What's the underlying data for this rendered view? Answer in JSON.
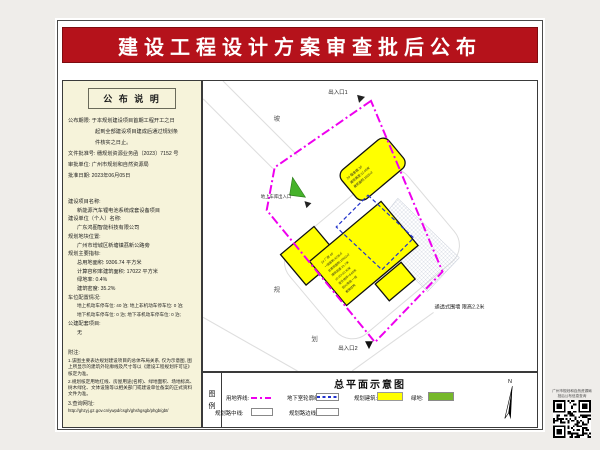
{
  "title": "建设工程设计方案审查批后公布",
  "left_panel": {
    "header": "公 布 说 明",
    "lines": [
      "公布期限: 于本规划建设项目首期工程开工之日",
      "起到全部建设项目建成后通过规划条",
      "件核实之日止。",
      "文件批准号: 穗规划资源业务函〔2023〕7152 号",
      "审批单位: 广州市规划和自然资源局",
      "批准日期: 2023年06月05日",
      "建设项目名称:",
      "新能源汽车锂电池系统成套设备项目",
      "建设单位（个人）名称:",
      "广东鸿图智能科技有限公司",
      "规划地块位置:",
      "广州市增城区新塘镇荔新公路旁",
      "规划主要指标:",
      "总用地面积: 9306.74 平方米",
      "计算容积率建筑面积: 17022 平方米",
      "绿地率: 0.4%",
      "建筑密度: 35.2%",
      "车位配置情况:",
      "地上机动车停车位: 40 泊; 地上非机动车停车位: 0 泊;",
      "地下机动车停车位: 0 泊; 地下非机动车停车位: 0 泊;",
      "公建配套项目:",
      "无",
      "附注:",
      "1.该图主要表达规划建设项目的总体布局关系, 仅为示意图, 图上所显示的建筑外轮廓线及尺寸等以《建设工程规划许可证》核定为准。",
      "2.规划核定用地红线、房屋用途(名称)、绿地面积、场地标高、树木绿化、文体设施等以相关部门或建设单位备案的正式资料文件为准。",
      "3.查询网址:",
      "http://ghzyj.gz.gov.cn/ywpd/csgh/ghshgsgb/phgb/gbt/"
    ]
  },
  "map": {
    "entrance1": "出入口1",
    "entrance2": "出入口2",
    "garage_entrance": "地上车库出入口",
    "wall_note": "通透式围墙 限高2.2米",
    "road_chars": [
      "坡",
      "规",
      "划"
    ],
    "building_top_lines": [
      "2# 宿舍楼 3F",
      "建筑高度:12.45米",
      "建筑面积:1020㎡"
    ],
    "building_main_lines": [
      "1# 厂房 4F",
      "一层面积:4236㎡",
      "总建筑面积:15902㎡",
      "建筑高度:23.7米",
      "±0.00=10.30米",
      "室外地坪=9.85米",
      "耐火等级:一级",
      "框架结构"
    ]
  },
  "legend": {
    "title": "总平面示意图",
    "box_label_chars": [
      "图",
      "例"
    ],
    "items": {
      "boundary": "用地界线:",
      "basement": "地下室轮廓线:",
      "building": "规划建筑:",
      "green": "绿地:",
      "road_center": "规划路中线:",
      "road_edge": "规划路边线:"
    },
    "north": "N"
  },
  "qr": {
    "caption1": "广州市规划和自然资源局",
    "caption2": "批后公布信息查询"
  },
  "colors": {
    "title_red": "#b5121b",
    "panel_bg": "#f6f3da",
    "boundary_magenta": "#ee00ee",
    "building_yellow": "#ffff00",
    "green": "#76b82a",
    "basement_blue": "#2233cc"
  }
}
